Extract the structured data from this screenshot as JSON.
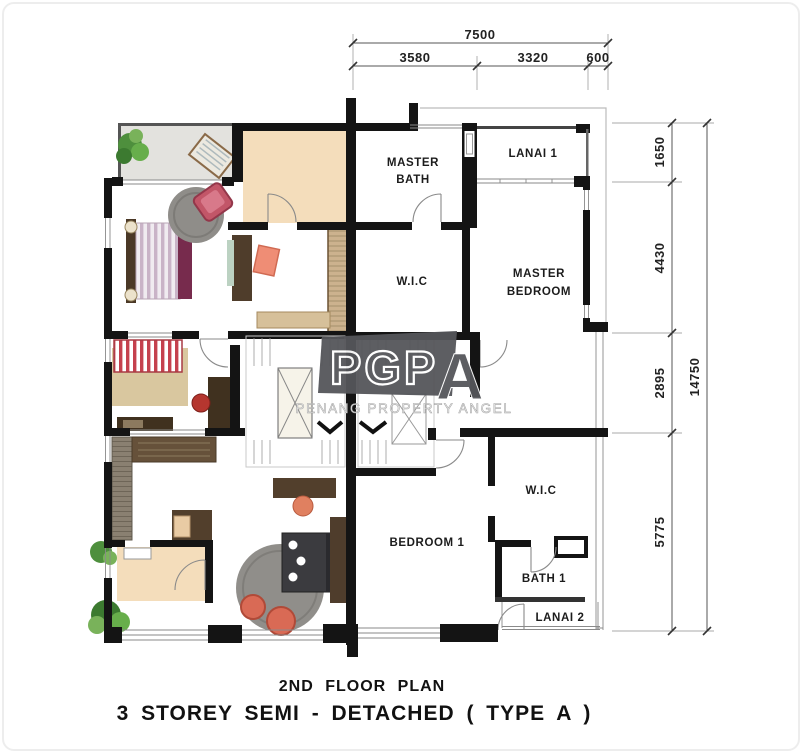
{
  "plan": {
    "titles": {
      "line1": "2ND FLOOR PLAN",
      "line2": "3 STOREY SEMI - DETACHED ( TYPE A )"
    },
    "watermark": {
      "logo_prefix": "PGP",
      "logo_suffix": "A",
      "tagline": "PENANG PROPERTY ANGEL",
      "banner_color": "#55565a"
    },
    "dimensions": {
      "top": {
        "total": "7500",
        "segments": [
          "3580",
          "3320",
          "600"
        ]
      },
      "right": {
        "total": "14750",
        "segments": [
          "1650",
          "4430",
          "2895",
          "5775"
        ]
      }
    },
    "rooms": {
      "master_bath": {
        "line1": "MASTER",
        "line2": "BATH"
      },
      "lanai1": "LANAI 1",
      "wic_top": "W.I.C",
      "master_bedroom": {
        "line1": "MASTER",
        "line2": "BEDROOM"
      },
      "wic_bottom": "W.I.C",
      "bedroom1": "BEDROOM 1",
      "bath1": "BATH 1",
      "lanai2": "LANAI 2"
    },
    "colors": {
      "wall": "#141414",
      "balcony_floor": "#e3e2de",
      "bath_floor_tan": "#f4ddbb",
      "rug_gray": "#8f8d89",
      "rug_tan": "#d9c79f",
      "accent_red": "#c25668",
      "accent_salmon": "#ef8d75",
      "accent_maroon": "#772b4d",
      "wood_dark": "#4f3d2b",
      "wardrobe_tan": "#ccb28e",
      "plant_green": "#4e8f3d",
      "bed_dark": "#3b3b3f"
    }
  }
}
